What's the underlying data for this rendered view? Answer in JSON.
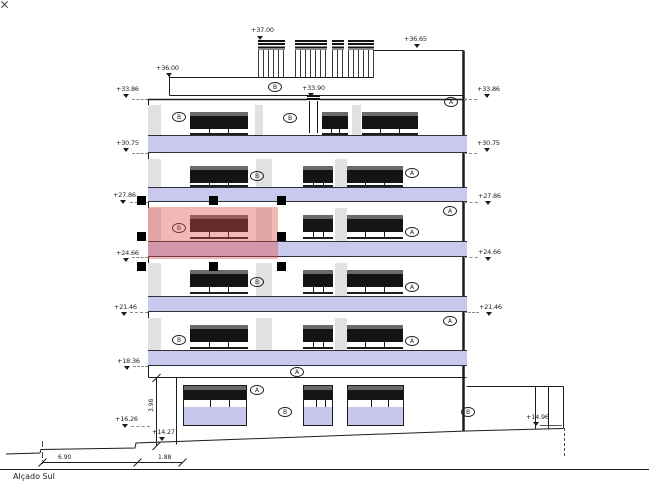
{
  "title": {
    "label": "Alçado Sul"
  },
  "colors": {
    "slab": "#c9c9ee",
    "glass": "#141414",
    "shutter_strip": "#6a6a6a",
    "pilaster": "#e1e1e1",
    "storefront_lower": "#c6c6ec",
    "selection_fill": "rgba(226,77,70,0.40)",
    "handle": "#000000",
    "ink": "#1d1d1d"
  },
  "level_markers": [
    {
      "label": "+37.00",
      "x": 251,
      "y": 27,
      "ax": 260,
      "ay": 36
    },
    {
      "label": "+36.65",
      "x": 404,
      "y": 36,
      "ax": 417,
      "ay": 44
    },
    {
      "label": "+36.00",
      "x": 156,
      "y": 65,
      "ax": 169,
      "ay": 73
    },
    {
      "label": "+33.90",
      "x": 302,
      "y": 85,
      "ax": 311,
      "ay": 93
    },
    {
      "label": "+33.86",
      "x": 116,
      "y": 86,
      "ax": 126,
      "ay": 94,
      "dash": [
        132,
        148,
        99
      ]
    },
    {
      "label": "+30.75",
      "x": 116,
      "y": 140,
      "ax": 126,
      "ay": 148,
      "dash": [
        132,
        148,
        153
      ]
    },
    {
      "label": "+27.86",
      "x": 113,
      "y": 192,
      "ax": 123,
      "ay": 200,
      "dash": [
        130,
        148,
        202
      ]
    },
    {
      "label": "+24.66",
      "x": 116,
      "y": 250,
      "ax": 126,
      "ay": 258,
      "dash": [
        132,
        148,
        257
      ]
    },
    {
      "label": "+21.46",
      "x": 114,
      "y": 304,
      "ax": 124,
      "ay": 312,
      "dash": [
        130,
        148,
        312
      ]
    },
    {
      "label": "+18.36",
      "x": 117,
      "y": 358,
      "ax": 127,
      "ay": 366,
      "dash": [
        133,
        148,
        366
      ]
    },
    {
      "label": "+16.26",
      "x": 115,
      "y": 416,
      "ax": 125,
      "ay": 424,
      "dash": [
        131,
        150,
        426
      ]
    },
    {
      "label": "+14.27",
      "x": 152,
      "y": 429,
      "ax": 162,
      "ay": 437
    },
    {
      "label": "+33.86",
      "x": 477,
      "y": 86,
      "ax": 487,
      "ay": 94,
      "dash": [
        464,
        477,
        99
      ]
    },
    {
      "label": "+30.75",
      "x": 477,
      "y": 140,
      "ax": 487,
      "ay": 148,
      "dash": [
        464,
        477,
        153
      ]
    },
    {
      "label": "+27.86",
      "x": 478,
      "y": 193,
      "ax": 488,
      "ay": 201,
      "dash": [
        464,
        478,
        202
      ]
    },
    {
      "label": "+24.66",
      "x": 478,
      "y": 249,
      "ax": 488,
      "ay": 257,
      "dash": [
        464,
        478,
        257
      ]
    },
    {
      "label": "+21.46",
      "x": 479,
      "y": 304,
      "ax": 489,
      "ay": 312,
      "dash": [
        464,
        479,
        312
      ]
    },
    {
      "label": "+14.96",
      "x": 526,
      "y": 414,
      "ax": 536,
      "ay": 422
    }
  ],
  "floors": [
    {
      "y_top": 99,
      "slab_top": 135,
      "slab_bot": 153,
      "pilasters": [
        [
          148,
          161
        ],
        [
          255,
          263
        ],
        [
          352,
          361
        ]
      ],
      "windows": [
        [
          190,
          248
        ],
        [
          322,
          348
        ],
        [
          362,
          418
        ]
      ],
      "chimney": {
        "x": 307,
        "w": 13,
        "cap_y": 95,
        "cap_h": 6
      }
    },
    {
      "y_top": 153,
      "slab_top": 187,
      "slab_bot": 202,
      "pilasters": [
        [
          148,
          161
        ],
        [
          256,
          272
        ],
        [
          335,
          347
        ]
      ],
      "windows": [
        [
          190,
          248
        ],
        [
          303,
          333
        ],
        [
          347,
          403
        ]
      ]
    },
    {
      "y_top": 202,
      "slab_top": 241,
      "slab_bot": 257,
      "pilasters": [
        [
          148,
          161
        ],
        [
          256,
          272
        ],
        [
          335,
          347
        ]
      ],
      "windows": [
        [
          190,
          248
        ],
        [
          303,
          333
        ],
        [
          347,
          403
        ]
      ]
    },
    {
      "y_top": 257,
      "slab_top": 296,
      "slab_bot": 312,
      "pilasters": [
        [
          148,
          161
        ],
        [
          256,
          272
        ],
        [
          335,
          347
        ]
      ],
      "windows": [
        [
          190,
          248
        ],
        [
          303,
          333
        ],
        [
          347,
          403
        ]
      ]
    },
    {
      "y_top": 312,
      "slab_top": 350,
      "slab_bot": 366,
      "pilasters": [
        [
          148,
          161
        ],
        [
          256,
          272
        ],
        [
          335,
          347
        ]
      ],
      "windows": [
        [
          190,
          248
        ],
        [
          303,
          333
        ],
        [
          347,
          403
        ]
      ]
    }
  ],
  "letters": [
    {
      "t": "B",
      "x": 275,
      "y": 87
    },
    {
      "t": "A",
      "x": 451,
      "y": 102
    },
    {
      "t": "B",
      "x": 179,
      "y": 117
    },
    {
      "t": "B",
      "x": 290,
      "y": 118
    },
    {
      "t": "B",
      "x": 257,
      "y": 176
    },
    {
      "t": "A",
      "x": 412,
      "y": 173
    },
    {
      "t": "A",
      "x": 450,
      "y": 211
    },
    {
      "t": "B",
      "x": 179,
      "y": 228
    },
    {
      "t": "A",
      "x": 412,
      "y": 232
    },
    {
      "t": "B",
      "x": 257,
      "y": 282
    },
    {
      "t": "A",
      "x": 412,
      "y": 287
    },
    {
      "t": "A",
      "x": 450,
      "y": 321
    },
    {
      "t": "B",
      "x": 179,
      "y": 340
    },
    {
      "t": "A",
      "x": 412,
      "y": 341
    },
    {
      "t": "A",
      "x": 297,
      "y": 372
    },
    {
      "t": "A",
      "x": 257,
      "y": 390
    },
    {
      "t": "B",
      "x": 285,
      "y": 412
    },
    {
      "t": "B",
      "x": 468,
      "y": 412
    }
  ],
  "railings": [
    [
      258,
      285
    ],
    [
      295,
      327
    ],
    [
      332,
      344
    ],
    [
      348,
      374
    ]
  ],
  "storefronts": [
    {
      "x": 183,
      "w": 64
    },
    {
      "x": 303,
      "w": 30
    },
    {
      "x": 347,
      "w": 57
    }
  ],
  "selection": {
    "x": 148,
    "y": 207,
    "w": 130,
    "h": 52,
    "handle_cols": [
      141,
      213,
      281
    ],
    "handle_rows": [
      200,
      236,
      266
    ],
    "center_mark": {
      "x": 213,
      "y": 236
    }
  },
  "dims": {
    "h1": "6.90",
    "h2": "1.88",
    "v": "3.98"
  }
}
